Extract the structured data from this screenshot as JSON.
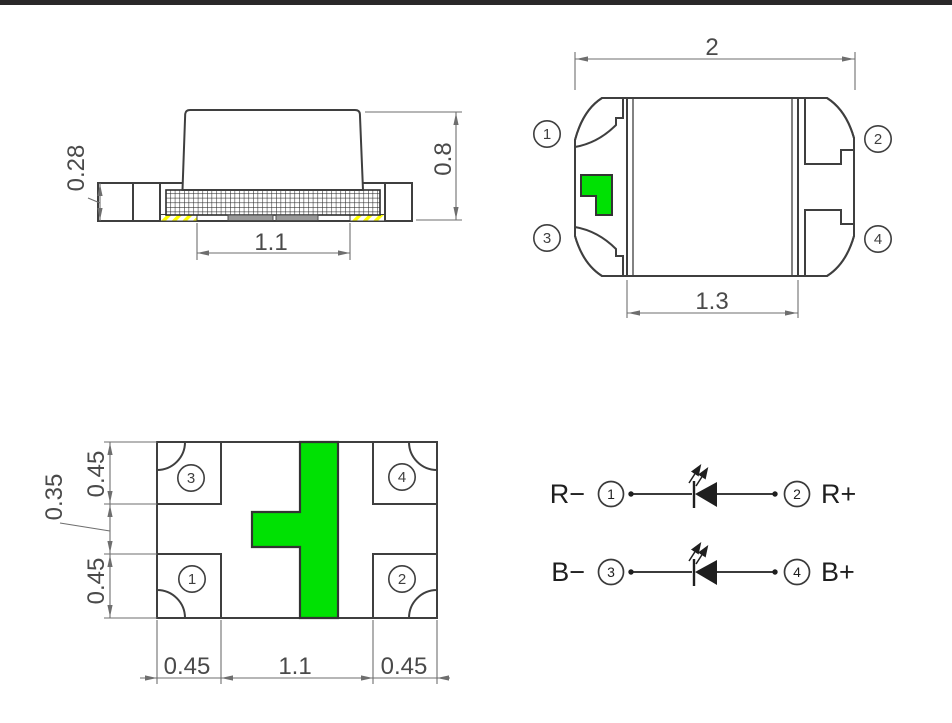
{
  "drawing": {
    "side_view": {
      "base_height": "0.28",
      "total_height": "0.8",
      "bottom_pad_width": "1.1"
    },
    "top_view": {
      "total_width": "2",
      "lens_width": "1.3",
      "pin_tl": "1",
      "pin_tr": "2",
      "pin_bl": "3",
      "pin_br": "4"
    },
    "bottom_view": {
      "side_top": "0.45",
      "side_gap": "0.35",
      "side_bottom": "0.45",
      "bottom_left": "0.45",
      "bottom_center": "1.1",
      "bottom_right": "0.45",
      "pin_tl": "3",
      "pin_tr": "4",
      "pin_bl": "1",
      "pin_br": "2"
    },
    "schematic": {
      "rows": [
        {
          "neg_label": "R−",
          "neg_pin": "1",
          "pos_pin": "2",
          "pos_label": "R+"
        },
        {
          "neg_label": "B−",
          "neg_pin": "3",
          "pos_pin": "4",
          "pos_label": "B+"
        }
      ]
    }
  },
  "colors": {
    "pad_yellow": "#ffff00",
    "marker_green": "#00e103",
    "outline": "#3f3f3f",
    "dim_line": "#6e6e6e",
    "dim_text": "#4a4a4a",
    "ink": "#1f1f1f",
    "top_bar": "#2a2829"
  }
}
